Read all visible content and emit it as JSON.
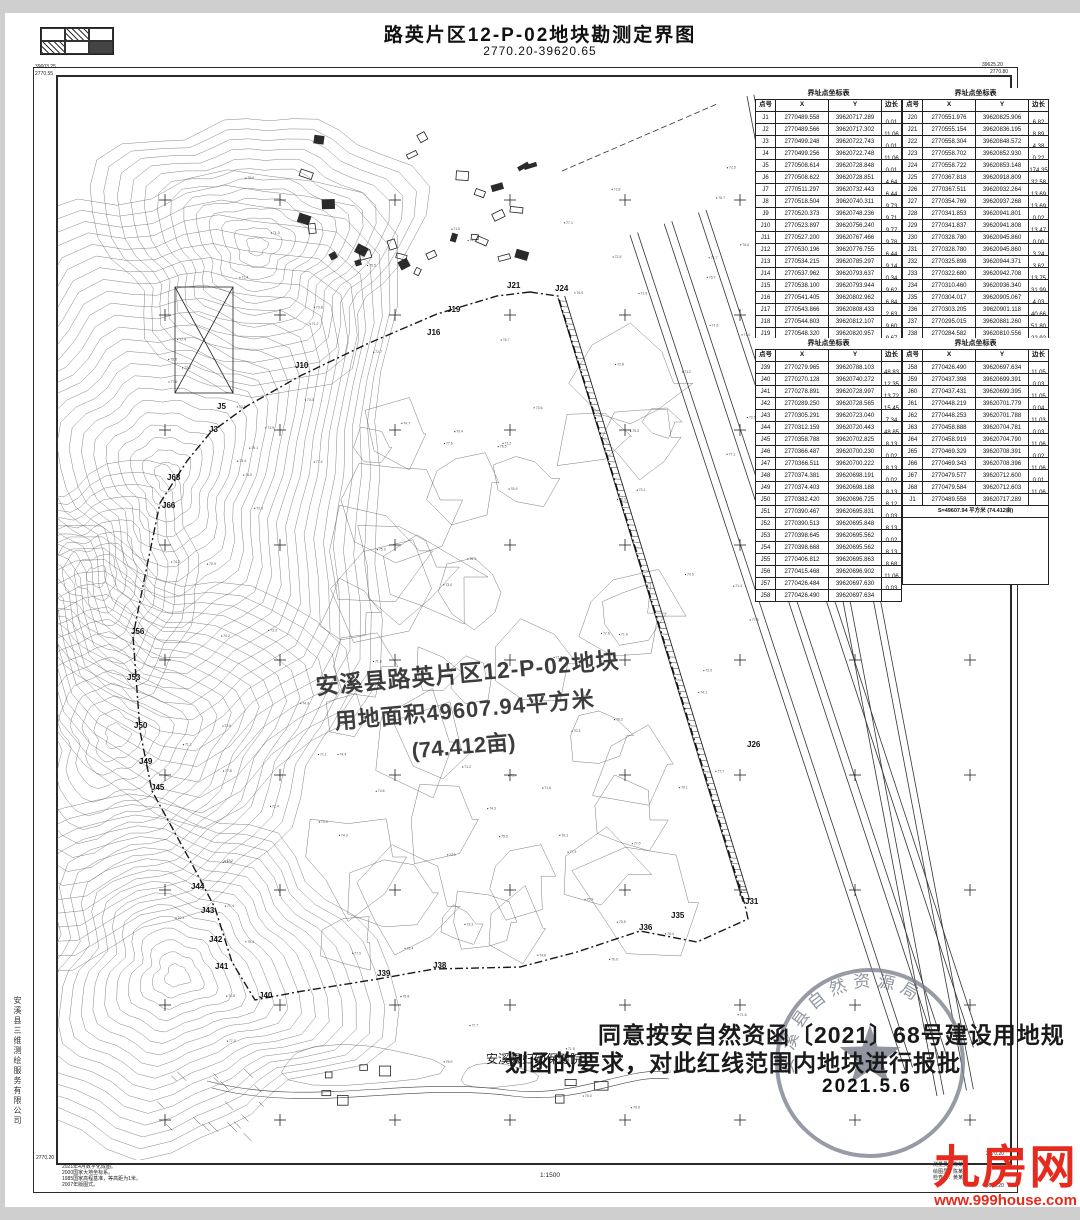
{
  "title": {
    "main": "路英片区12-P-02地块勘测定界图",
    "sheet_no": "2770.20-39620.65"
  },
  "corner_labels": {
    "tl1": "39603.25",
    "tl2": "2770.55",
    "tr1": "39625.20",
    "tr2": "2770.80",
    "br1": "2770.20",
    "br2": "39625.20",
    "bl": "2770.20"
  },
  "tables": {
    "title": "界址点坐标表",
    "headers": [
      "点号",
      "X",
      "Y",
      "边长"
    ],
    "b1l": {
      "rows": [
        [
          "J1",
          "2770489.558",
          "39620717.289"
        ],
        [
          "J2",
          "2770489.566",
          "39620717.302"
        ],
        [
          "J3",
          "2770499.248",
          "39620722.743"
        ],
        [
          "J4",
          "2770499.256",
          "39620722.748"
        ],
        [
          "J5",
          "2770508.614",
          "39620728.848"
        ],
        [
          "J6",
          "2770508.622",
          "39620728.851"
        ],
        [
          "J7",
          "2770511.297",
          "39620732.443"
        ],
        [
          "J8",
          "2770518.504",
          "39620740.311"
        ],
        [
          "J9",
          "2770520.373",
          "39620748.236"
        ],
        [
          "J10",
          "2770523.897",
          "39620756.240"
        ],
        [
          "J11",
          "2770527.200",
          "39620767.466"
        ],
        [
          "J12",
          "2770530.196",
          "39620776.755"
        ],
        [
          "J13",
          "2770534.215",
          "39620785.297"
        ],
        [
          "J14",
          "2770537.962",
          "39620793.637"
        ],
        [
          "J15",
          "2770538.100",
          "39620793.944"
        ],
        [
          "J16",
          "2770541.405",
          "39620802.962"
        ],
        [
          "J17",
          "2770543.866",
          "39620808.433"
        ],
        [
          "J18",
          "2770544.803",
          "39620812.107"
        ],
        [
          "J19",
          "2770548.320",
          "39620820.957"
        ],
        [
          "J20",
          "2770551.976",
          "39620825.906"
        ]
      ],
      "lens": [
        "0.01",
        "11.06",
        "0.01",
        "11.06",
        "0.01",
        "4.64",
        "6.44",
        "9.73",
        "9.71",
        "9.77",
        "9.78",
        "6.44",
        "9.14",
        "0.34",
        "9.62",
        "6.84",
        "2.63",
        "9.60",
        "9.67"
      ]
    },
    "b1r": {
      "rows": [
        [
          "J20",
          "2770551.976",
          "39620825.906"
        ],
        [
          "J21",
          "2770555.154",
          "39620836.195"
        ],
        [
          "J22",
          "2770558.304",
          "39620848.572"
        ],
        [
          "J23",
          "2770558.702",
          "39620852.930"
        ],
        [
          "J24",
          "2770558.722",
          "39620853.148"
        ],
        [
          "J25",
          "2770367.818",
          "39620918.809"
        ],
        [
          "J26",
          "2770367.511",
          "39620932.264"
        ],
        [
          "J27",
          "2770354.769",
          "39620937.268"
        ],
        [
          "J28",
          "2770341.853",
          "39620941.801"
        ],
        [
          "J29",
          "2770341.837",
          "39620941.808"
        ],
        [
          "J30",
          "2770328.780",
          "39620945.860"
        ],
        [
          "J31",
          "2770328.780",
          "39620945.860"
        ],
        [
          "J32",
          "2770325.898",
          "39620944.371"
        ],
        [
          "J33",
          "2770322.680",
          "39620942.708"
        ],
        [
          "J34",
          "2770310.460",
          "39620936.340"
        ],
        [
          "J35",
          "2770304.017",
          "39620905.067"
        ],
        [
          "J36",
          "2770303.205",
          "39620901.118"
        ],
        [
          "J37",
          "2770295.015",
          "39620881.260"
        ],
        [
          "J38",
          "2770284.582",
          "39620810.556"
        ],
        [
          "J39",
          "2770279.965",
          "39620788.103"
        ]
      ],
      "lens": [
        "6.82",
        "8.89",
        "4.38",
        "0.22",
        "174.35",
        "32.58",
        "13.69",
        "13.69",
        "0.02",
        "13.47",
        "0.00",
        "3.24",
        "3.62",
        "13.75",
        "31.99",
        "4.03",
        "40.66",
        "51.80",
        "22.92"
      ]
    },
    "b2l": {
      "rows": [
        [
          "J39",
          "2770279.965",
          "39620788.103"
        ],
        [
          "J40",
          "2770270.128",
          "39620740.272"
        ],
        [
          "J41",
          "2770278.891",
          "39620728.997"
        ],
        [
          "J42",
          "2770289.250",
          "39620728.565"
        ],
        [
          "J43",
          "2770305.291",
          "39620723.040"
        ],
        [
          "J44",
          "2770312.159",
          "39620720.443"
        ],
        [
          "J45",
          "2770358.788",
          "39620702.825"
        ],
        [
          "J46",
          "2770366.487",
          "39620700.230"
        ],
        [
          "J47",
          "2770366.511",
          "39620700.222"
        ],
        [
          "J48",
          "2770374.381",
          "39620698.191"
        ],
        [
          "J49",
          "2770374.403",
          "39620698.188"
        ],
        [
          "J50",
          "2770382.420",
          "39620696.725"
        ],
        [
          "J51",
          "2770390.467",
          "39620695.831"
        ],
        [
          "J52",
          "2770390.513",
          "39620695.848"
        ],
        [
          "J53",
          "2770398.645",
          "39620695.562"
        ],
        [
          "J54",
          "2770398.668",
          "39620695.562"
        ],
        [
          "J55",
          "2770406.812",
          "39620695.863"
        ],
        [
          "J56",
          "2770415.468",
          "39620696.902"
        ],
        [
          "J57",
          "2770426.484",
          "39620697.630"
        ],
        [
          "J58",
          "2770426.490",
          "39620697.634"
        ]
      ],
      "lens": [
        "48.83",
        "12.35",
        "13.72",
        "15.45",
        "7.34",
        "48.85",
        "8.13",
        "0.02",
        "8.13",
        "0.02",
        "8.13",
        "8.12",
        "0.03",
        "8.13",
        "0.02",
        "8.13",
        "8.68",
        "11.06",
        "0.03"
      ]
    },
    "b2r": {
      "rows": [
        [
          "J58",
          "2770426.490",
          "39620697.634"
        ],
        [
          "J59",
          "2770437.398",
          "39620699.391"
        ],
        [
          "J60",
          "2770437.431",
          "39620699.395"
        ],
        [
          "J61",
          "2770448.219",
          "39620701.779"
        ],
        [
          "J62",
          "2770448.253",
          "39620701.788"
        ],
        [
          "J63",
          "2770458.888",
          "39620704.781"
        ],
        [
          "J64",
          "2770458.919",
          "39620704.790"
        ],
        [
          "J65",
          "2770469.329",
          "39620708.391"
        ],
        [
          "J66",
          "2770469.343",
          "39620708.396"
        ],
        [
          "J67",
          "2770479.577",
          "39620712.600"
        ],
        [
          "J68",
          "2770479.584",
          "39620712.603"
        ],
        [
          "J1",
          "2770489.558",
          "39620717.289"
        ]
      ],
      "lens": [
        "11.05",
        "0.03",
        "11.05",
        "0.04",
        "11.03",
        "0.03",
        "11.06",
        "0.02",
        "11.06",
        "0.01",
        "11.06"
      ],
      "footer": "S=49607.94 平方米 (74.412亩)"
    }
  },
  "map": {
    "label_lines": [
      "安溪县路英片区12-P-02地块",
      "用地面积49607.94平方米",
      "(74.412亩)"
    ],
    "point_labels": [
      {
        "t": "J21",
        "x": 450,
        "y": 212
      },
      {
        "t": "J24",
        "x": 498,
        "y": 215
      },
      {
        "t": "J19",
        "x": 390,
        "y": 236
      },
      {
        "t": "J16",
        "x": 370,
        "y": 259
      },
      {
        "t": "J10",
        "x": 238,
        "y": 292
      },
      {
        "t": "J5",
        "x": 160,
        "y": 333
      },
      {
        "t": "J3",
        "x": 152,
        "y": 356
      },
      {
        "t": "J68",
        "x": 110,
        "y": 404
      },
      {
        "t": "J66",
        "x": 105,
        "y": 432
      },
      {
        "t": "J56",
        "x": 74,
        "y": 558
      },
      {
        "t": "J53",
        "x": 70,
        "y": 604
      },
      {
        "t": "J50",
        "x": 77,
        "y": 652
      },
      {
        "t": "J49",
        "x": 82,
        "y": 688
      },
      {
        "t": "J45",
        "x": 94,
        "y": 714
      },
      {
        "t": "J44",
        "x": 134,
        "y": 813
      },
      {
        "t": "J43",
        "x": 144,
        "y": 837
      },
      {
        "t": "J42",
        "x": 152,
        "y": 866
      },
      {
        "t": "J41",
        "x": 158,
        "y": 893
      },
      {
        "t": "J40",
        "x": 202,
        "y": 922
      },
      {
        "t": "J39",
        "x": 320,
        "y": 900
      },
      {
        "t": "J38",
        "x": 376,
        "y": 892
      },
      {
        "t": "J36",
        "x": 582,
        "y": 854
      },
      {
        "t": "J35",
        "x": 614,
        "y": 842
      },
      {
        "t": "J31",
        "x": 688,
        "y": 828
      },
      {
        "t": "J26",
        "x": 690,
        "y": 671
      }
    ],
    "pond_label": "(水塘)"
  },
  "approval": {
    "line1": "同意按安自然资函〔2021〕68号建设用地规",
    "line2": "划函的要求，对此红线范围内地块进行报批",
    "hospital": "安溪县妇幼保健院",
    "date": "2021.5.6",
    "stamp_ring": "安溪县自然资源局"
  },
  "footer": {
    "notes": [
      "2021年4月数字化成图。",
      "2000国家大地坐标系。",
      "1985国家高程基准，等高距为1米。",
      "2007年版图式。"
    ],
    "scale": "1:1500",
    "staff": [
      "测量员：陈某某",
      "绘图员：陈某某",
      "检查员：黄某某"
    ],
    "company": "安溪县三维测绘服务有限公司"
  },
  "watermark": {
    "name": "九房网",
    "url": "www.999house.com"
  }
}
